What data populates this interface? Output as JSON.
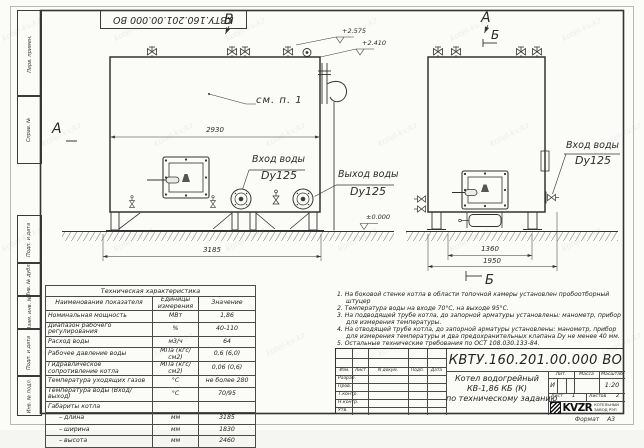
{
  "watermark": "kotel-kv.kz",
  "frame": {
    "top_stamp": "КВТУ.160.201.00.000 ВО",
    "left_labels": [
      "Перв. примен.",
      "Справ. №",
      "Подп. и дата",
      "Инв. № дубл.",
      "Взам. инв. №",
      "Подп. и дата",
      "Инв. № подл."
    ],
    "format_label": "Формат",
    "format_value": "А3"
  },
  "front_view": {
    "marker_v": "В",
    "marker_a": "А",
    "see_ref": "см. п. 1",
    "dim_width": "2930",
    "dim_base": "3185",
    "elev_top": "+2.575",
    "elev_mid": "+2.410",
    "elev_zero": "±0.000",
    "inlet_title": "Вход воды",
    "inlet_dn": "Dy125",
    "outlet_title": "Выход воды",
    "outlet_dn": "Dy125"
  },
  "side_view": {
    "marker_a": "А",
    "marker_b_top": "Б",
    "marker_b_bottom": "Б",
    "inlet_title": "Вход воды",
    "inlet_dn": "Dy125",
    "dim_inner": "1360",
    "dim_outer": "1950"
  },
  "tech_table": {
    "title": "Техническая характеристика",
    "headers": [
      "Наименование показателя",
      "Единицы измерения",
      "Значение"
    ],
    "rows": [
      [
        "Номинальная мощность",
        "МВт",
        "1,86"
      ],
      [
        "Диапазон рабочего регулирования",
        "%",
        "40-110"
      ],
      [
        "Расход воды",
        "м3/ч",
        "64"
      ],
      [
        "Рабочее давление воды",
        "МПа (кгс/см2)",
        "0,6 (6,0)"
      ],
      [
        "Гидравлическое сопротивление котла",
        "МПа (кгс/см2)",
        "0,06 (0,6)"
      ],
      [
        "Температура уходящих газов",
        "°С",
        "не более 280"
      ],
      [
        "Температура воды (Вход/выход)",
        "°С",
        "70/95"
      ],
      [
        "Габариты котла",
        "",
        ""
      ],
      [
        "– длина",
        "мм",
        "3185"
      ],
      [
        "– ширина",
        "мм",
        "1830"
      ],
      [
        "– высота",
        "мм",
        "2460"
      ]
    ]
  },
  "notes": [
    "1.  На боковой стенке котла в области топочной камеры установлен пробоотборный штуцер",
    "2.  Температура воды на входе 70°С, на выходе 95°С.",
    "3.  На подводящей трубе котла, до запорной арматуры установлены: манометр, прибор для измерения температуры.",
    "4.  На отводящей трубе котла, до запорной арматуры установлены: манометр, прибор для измерения температуры и два предохранительных клапана Dу не менее 40 мм.",
    "5.  Остальные технические требования по ОСТ 108.030.133-84."
  ],
  "title_block": {
    "doc_number": "КВТУ.160.201.00.000  ВО",
    "product_line1": "Котел водогрейный",
    "product_line2": "КВ-1,86  КБ  (К)",
    "product_line3": "по техническому заданию",
    "col_headers": [
      "Изм.",
      "Лист",
      "N докум.",
      "Подп.",
      "Дата"
    ],
    "row_labels": [
      "Разраб.",
      "Пров.",
      "Т.контр.",
      "Н.контр.",
      "Утв."
    ],
    "lit_label": "Лит.",
    "lit_value": "И",
    "mass_label": "Масса",
    "scale_label": "Масштаб",
    "scale_value": "1:20",
    "sheet_label": "Лист",
    "sheet_value": "1",
    "sheets_label": "Листов",
    "sheets_value": "2",
    "logo_text": "KVZR",
    "logo_sub1": "КОТЕЛЬНЫЙ",
    "logo_sub2": "ЗАВОД РЭП"
  }
}
